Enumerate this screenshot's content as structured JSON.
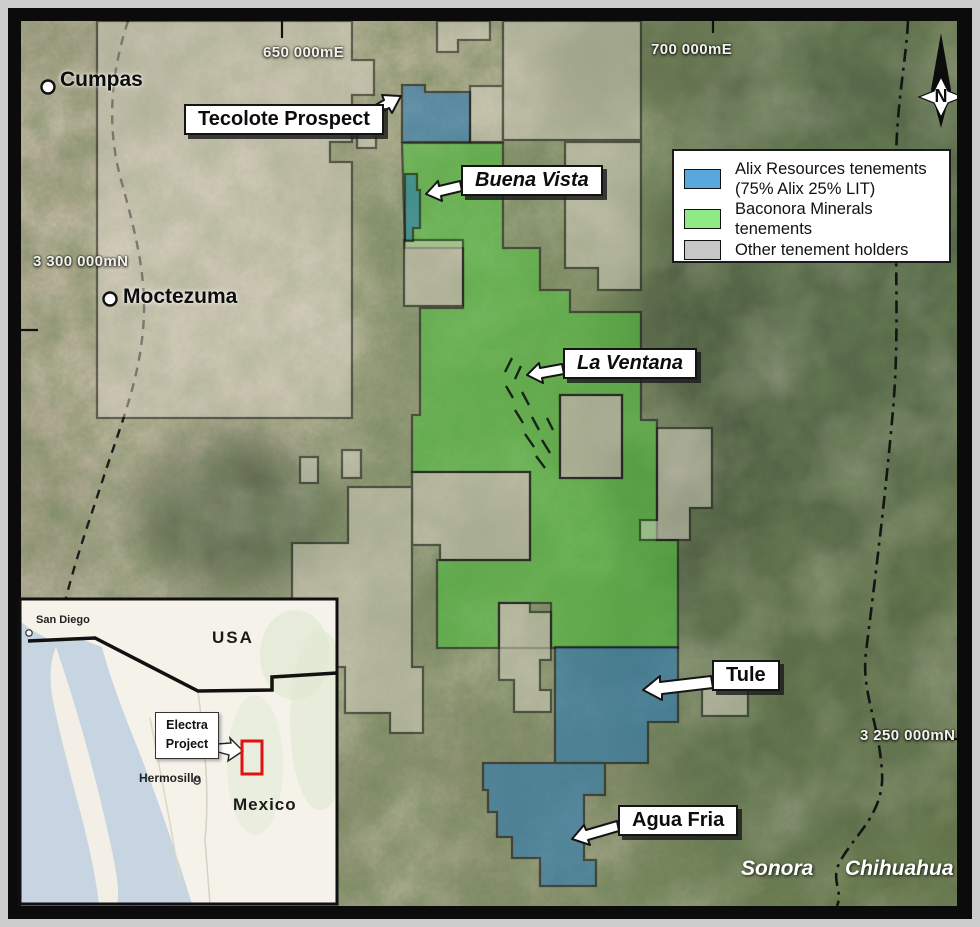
{
  "map": {
    "grid_labels": {
      "east1": "650 000mE",
      "east2": "700 000mE",
      "north1": "3 300 000mN",
      "north2": "3 250 000mN"
    },
    "towns": {
      "cumpas": "Cumpas",
      "moctezuma": "Moctezuma"
    },
    "states": {
      "sonora": "Sonora",
      "chihuahua": "Chihuahua"
    },
    "annotations": {
      "tecolote": "Tecolote Prospect",
      "buena_vista": "Buena Vista",
      "la_ventana": "La Ventana",
      "tule": "Tule",
      "agua_fria": "Agua Fria"
    },
    "north_arrow": "N"
  },
  "legend": {
    "items": [
      {
        "label": "Alix Resources tenements",
        "sublabel": "(75% Alix 25% LIT)",
        "color": "#58a8dd"
      },
      {
        "label": "Baconora Minerals tenements",
        "sublabel": "",
        "color": "#8fe987"
      },
      {
        "label": "Other tenement holders",
        "sublabel": "",
        "color": "#c7c7c7"
      }
    ]
  },
  "inset": {
    "usa": "USA",
    "mexico": "Mexico",
    "san_diego": "San Diego",
    "hermosillo": "Hermosillo",
    "project_line1": "Electra",
    "project_line2": "Project"
  },
  "colors": {
    "alix_fill": "#2e7bb4",
    "baconora_fill": "#4fc43d",
    "other_fill": "#d8d2c4"
  }
}
